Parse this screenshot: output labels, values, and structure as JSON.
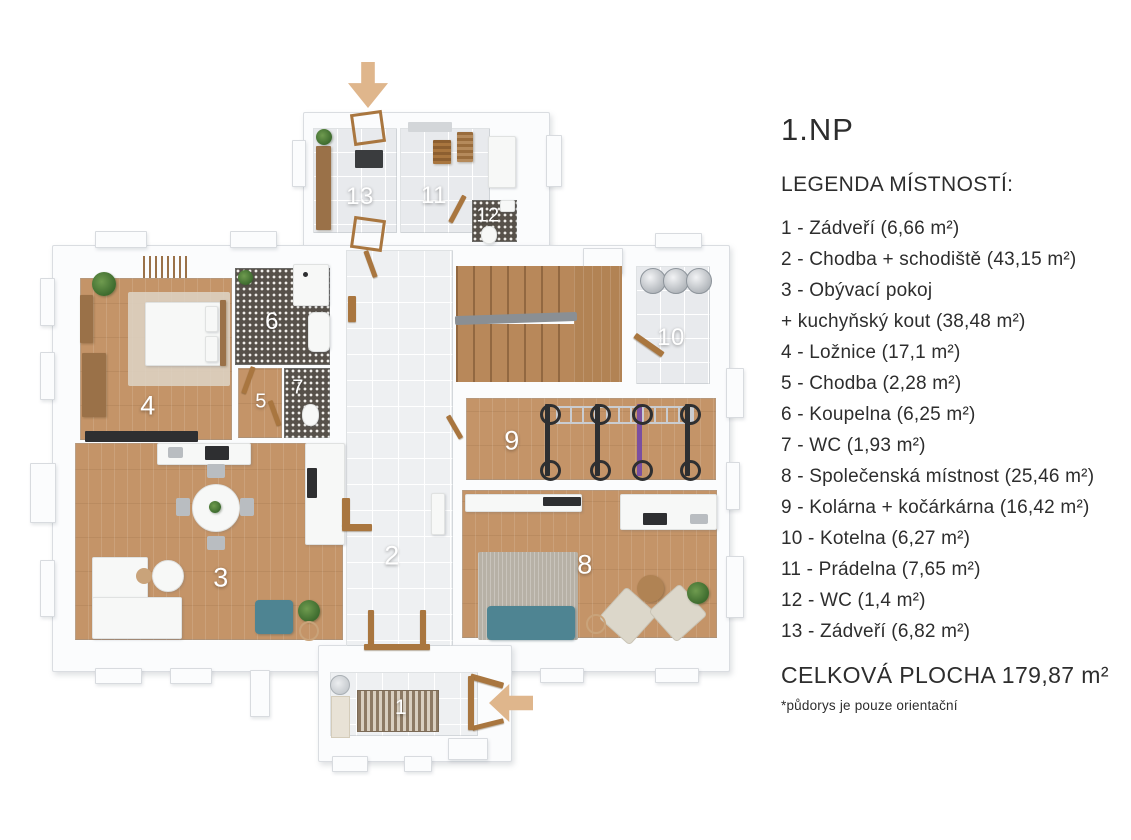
{
  "legend": {
    "floor_title": "1.NP",
    "heading": "LEGENDA MÍSTNOSTÍ:",
    "lines": [
      "1 - Zádveří (6,66 m²)",
      "2 - Chodba + schodiště (43,15 m²)",
      "3 - Obývací pokoj",
      "+ kuchyňský kout (38,48 m²)",
      "4 - Ložnice (17,1 m²)",
      "5 - Chodba (2,28 m²)",
      "6 - Koupelna (6,25 m²)",
      "7 - WC (1,93 m²)",
      "8 - Společenská místnost (25,46 m²)",
      "9 - Kolárna + kočárkárna (16,42 m²)",
      "10 - Kotelna (6,27 m²)",
      "11 - Prádelna (7,65 m²)",
      "12 - WC (1,4 m²)",
      "13 - Zádveří (6,82 m²)"
    ],
    "total": "CELKOVÁ PLOCHA 179,87 m²",
    "footnote": "*půdorys je pouze orientační"
  },
  "plan": {
    "room_numbers": {
      "r1": "1",
      "r2": "2",
      "r3": "3",
      "r4": "4",
      "r5": "5",
      "r6": "6",
      "r7": "7",
      "r8": "8",
      "r9": "9",
      "r10": "10",
      "r11": "11",
      "r12": "12",
      "r13": "13"
    },
    "colors": {
      "wood_floor": "#c49468",
      "tile_floor": "#e8eaed",
      "dark_tile_floor": "#57514a",
      "stair_wood": "#b8885a",
      "wall": "#fbfcfd",
      "accent_teal": "#4e8492",
      "entry_arrow_tan": "#dfb68c",
      "door_brown": "#a9763f",
      "text": "#2d2d2d",
      "room_number_text": "#ffffff"
    }
  }
}
